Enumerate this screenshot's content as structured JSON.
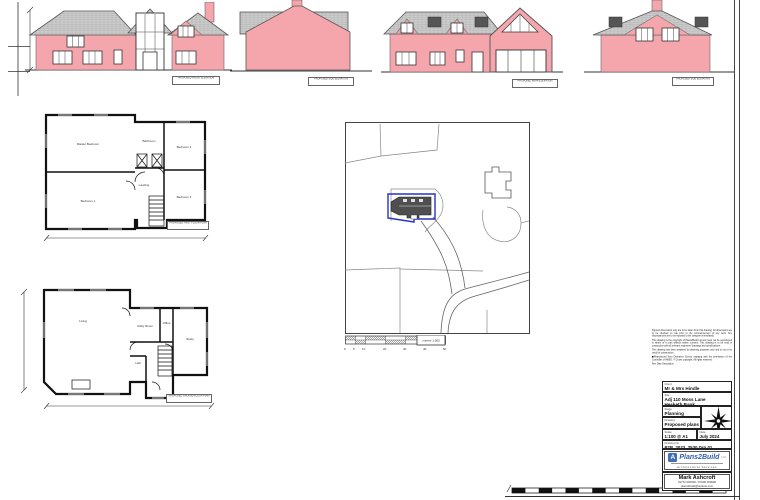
{
  "palette": {
    "wall_pink": "#F5A6AC",
    "roof_grey": "#CCCCCC",
    "site_boundary_blue": "#2633C4",
    "logo_blue": "#3F6FB5",
    "line_dark": "#333333"
  },
  "elevations": {
    "front_label": "PROPOSED FRONT ELEVATION",
    "side_label_1": "PROPOSED SIDE ELEVATION",
    "rear_label": "PROPOSED REAR ELEVATION",
    "side_label_2": "PROPOSED SIDE ELEVATION"
  },
  "first_floor": {
    "label": "PROPOSED FIRST FLOOR PLAN",
    "rooms": {
      "master": "Master Bedroom",
      "bathroom": "Bathroom",
      "bedroom1": "Bedroom 1",
      "bedroom2": "Bedroom 2",
      "bedroom3": "Bedroom 3",
      "landing": "Landing"
    }
  },
  "ground_floor": {
    "label": "PROPOSED GROUND FLOOR PLAN",
    "rooms": {
      "living": "Living",
      "utility": "Utility Room",
      "office": "Office",
      "study": "Study",
      "hall": "Hall"
    }
  },
  "site_plan": {
    "scale_ticks": [
      "0",
      "5",
      "10",
      "20",
      "30",
      "40",
      "50"
    ],
    "scale_box": "metres 1:500"
  },
  "title_block": {
    "notes": [
      "Figured dimensions only are to be taken from this drawing. All dimensions are to be checked on site prior to the commencement of any work. Any discrepancies are to be reported to the designer immediately.",
      "This drawing is the copyright of Plans2Build Ltd and must not be reproduced in whole or in part without written consent. This drawing is to be read in conjunction with all relevant engineers' drawings and specifications.",
      "This drawing has been prepared for planning purposes only and is not to be used for construction.",
      "Reproduced from Ordnance Survey mapping with the permission of the Controller of HMSO. © Crown copyright. All rights reserved."
    ],
    "notes_footer": "Rev    Date    Description",
    "rows": {
      "client_label": "Client",
      "client": "Mr & Mrs Hindle",
      "site_label": "Site",
      "site_line1": "Adj 110 Moss Lane",
      "site_line2": "Hesketh Bank",
      "stage_label": "Stage",
      "stage": "Planning",
      "drawing_label": "Drawing",
      "drawing": "Proposed plans",
      "scale_label": "Scale",
      "scale": "1:100 @ A1",
      "date_label": "Date",
      "date": "July 2024",
      "number_label": "Drawing No",
      "number": "P2B_2023_2530 Drg 01"
    },
    "logo": {
      "initial": "A",
      "name": "Plans2Build",
      "suffix": "Ltd",
      "tagline": "Architectural Services"
    },
    "contact": {
      "name": "Mark Ashcroft",
      "phone": "01772 000000 / 07000 000000",
      "email": "plans2build@outlook.com"
    }
  }
}
